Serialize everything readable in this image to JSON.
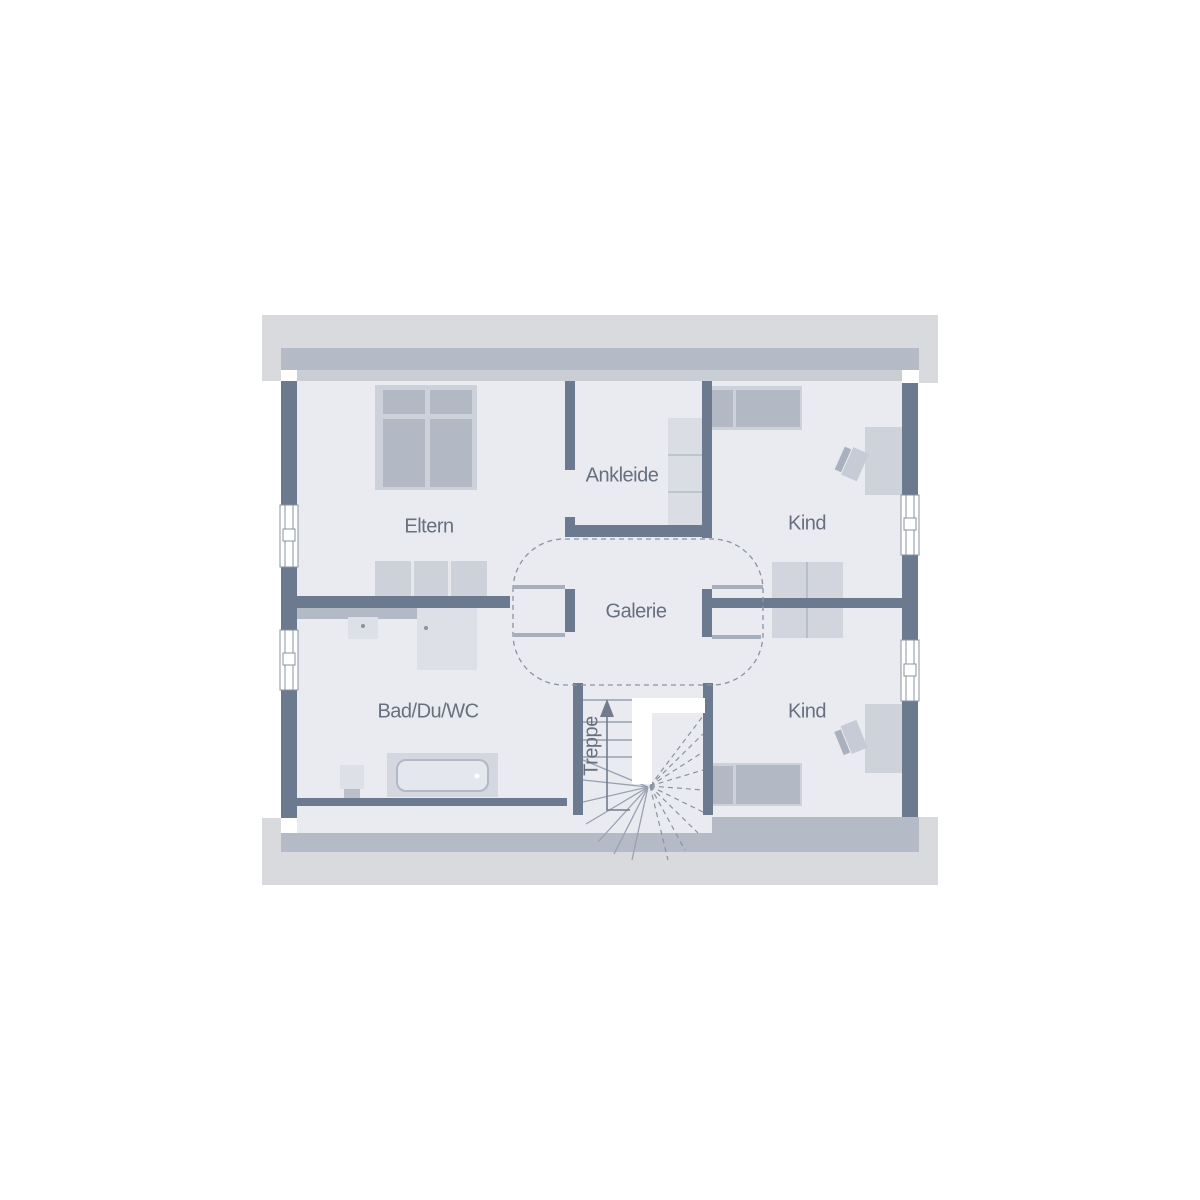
{
  "floorplan": {
    "type": "residential-upper-floor-plan",
    "rooms": [
      {
        "id": "eltern",
        "label": "Eltern"
      },
      {
        "id": "ankleide",
        "label": "Ankleide"
      },
      {
        "id": "kind_top",
        "label": "Kind"
      },
      {
        "id": "galerie",
        "label": "Galerie"
      },
      {
        "id": "bad",
        "label": "Bad/Du/WC"
      },
      {
        "id": "kind_bottom",
        "label": "Kind"
      },
      {
        "id": "treppe",
        "label": "Treppe"
      }
    ],
    "symbols": [
      "double-bed",
      "sideboard",
      "wardrobe",
      "single-bed",
      "desk",
      "desk-chair",
      "double-desk",
      "bathtub",
      "shower",
      "washbasin",
      "wc",
      "window",
      "door-leaf",
      "door-swing-arc",
      "winder-staircase",
      "stair-direction-arrow-up",
      "roof-overhang"
    ],
    "colors": {
      "background": "#ffffff",
      "roof_overhang": "#d8dade",
      "wall_section_medium": "#b5bbc6",
      "wall_section_light": "#c9cdd4",
      "floor": "#e9ebf1",
      "wall_dark": "#6b7a8e",
      "furniture_light": "#cdd1da",
      "furniture_medium": "#b2b8c4",
      "furniture_pale": "#dde0e7",
      "door_leaf": "#a8afbc",
      "dashed_line": "#8a93a2",
      "label_text": "#67707f"
    }
  }
}
